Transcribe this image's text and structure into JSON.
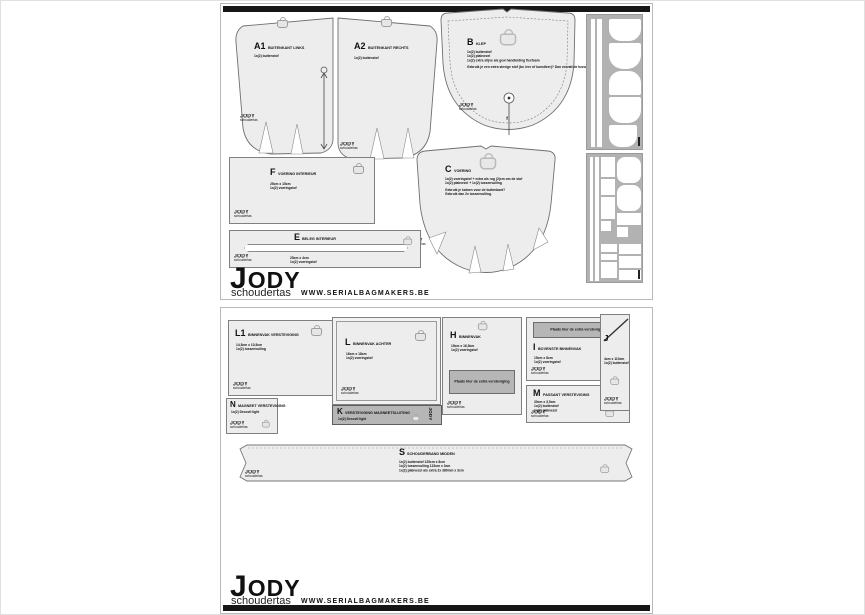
{
  "brand": {
    "logo": "JODY",
    "sub": "schoudertas",
    "url": "WWW.SERIALBAGMAKERS.BE"
  },
  "s1": {
    "a1": {
      "code": "A1",
      "name": "BUITENKANT LINKS",
      "line1": "1x(2) buitenstof"
    },
    "a2": {
      "code": "A2",
      "name": "BUITENKANT RECHTS",
      "line1": "1x(2) buitenstof"
    },
    "b": {
      "code": "B",
      "name": "KLEP",
      "line1": "1x(2) buitenstof",
      "line2": "1x(2) plakvezel",
      "line3": "1x(2) extra stijve als gew handleiding flexfoam",
      "line4": "Gebruik je een extra stevige stof (bv. leer of kunstleer)? Dan vervalt de tussenlaag flexfoam.",
      "notch": "f"
    },
    "c": {
      "code": "C",
      "name": "VOERING",
      "line1": "1x(2) voeringstof + extra als rug (2)cm om de stof",
      "line2": "1x(2) plakvezel + 1x(2) tussenvulling",
      "line3": "Gebruik je katoen voor de buitenkant?",
      "line4": "Gebruik dan 2x tussenvulling."
    },
    "f": {
      "code": "F",
      "name": "VOERING INTERIEUR",
      "line1": "25cm x 15cm",
      "line2": "1x(2) voeringstof"
    },
    "e": {
      "code": "E",
      "name": "BELEG INTERIEUR",
      "line1": "25cm x 4cm",
      "line2": "1x(2) voeringstof"
    }
  },
  "s2": {
    "bar_text": "Plaats hier de extra versteviging",
    "l1": {
      "code": "L1",
      "name": "BINNENVAK VERSTEVIGING",
      "line1": "14,5cm x 10,5cm",
      "line2": "1x(2) tussenvulling"
    },
    "l": {
      "code": "L",
      "name": "BINNENVAK ACHTER",
      "line1": "16cm x 18cm",
      "line2": "1x(2) voeringstof"
    },
    "h": {
      "code": "H",
      "name": "BINNENVAK",
      "line1": "15cm x 16,5cm",
      "line2": "1x(2) voeringstof"
    },
    "i": {
      "code": "I",
      "name": "BOVENSTE BINNENVAK",
      "line1": "15cm x 8cm",
      "line2": "1x(2) voeringstof"
    },
    "m": {
      "code": "M",
      "name": "PASSANT VERSTEVIGING",
      "line1": "30cm x 3,5cm",
      "line2": "1x(2) buitenstof",
      "line3": "1x(2) plakvezel"
    },
    "n": {
      "code": "N",
      "name": "MAGNEET VERSTEVIGING",
      "line1": "1x(2) Decovil light"
    },
    "k": {
      "code": "K",
      "name": "VERSTEVIGING MAGNEETSLUITING",
      "line1": "1x(2) Decovil light"
    },
    "j": {
      "code": "J",
      "line1": "4cm x 110cm",
      "line2": "1x(2) buitenstof"
    },
    "s": {
      "code": "S",
      "name": "SCHOUDERBAND MIDDEN",
      "line1": "1x(2) buitenstof 125cm x 8cm",
      "line2": "1x(2) tussenvulling 123cm x 3cm",
      "line3": "1x(2) plakvezel als extra 2x 380mm x 3cm"
    }
  }
}
